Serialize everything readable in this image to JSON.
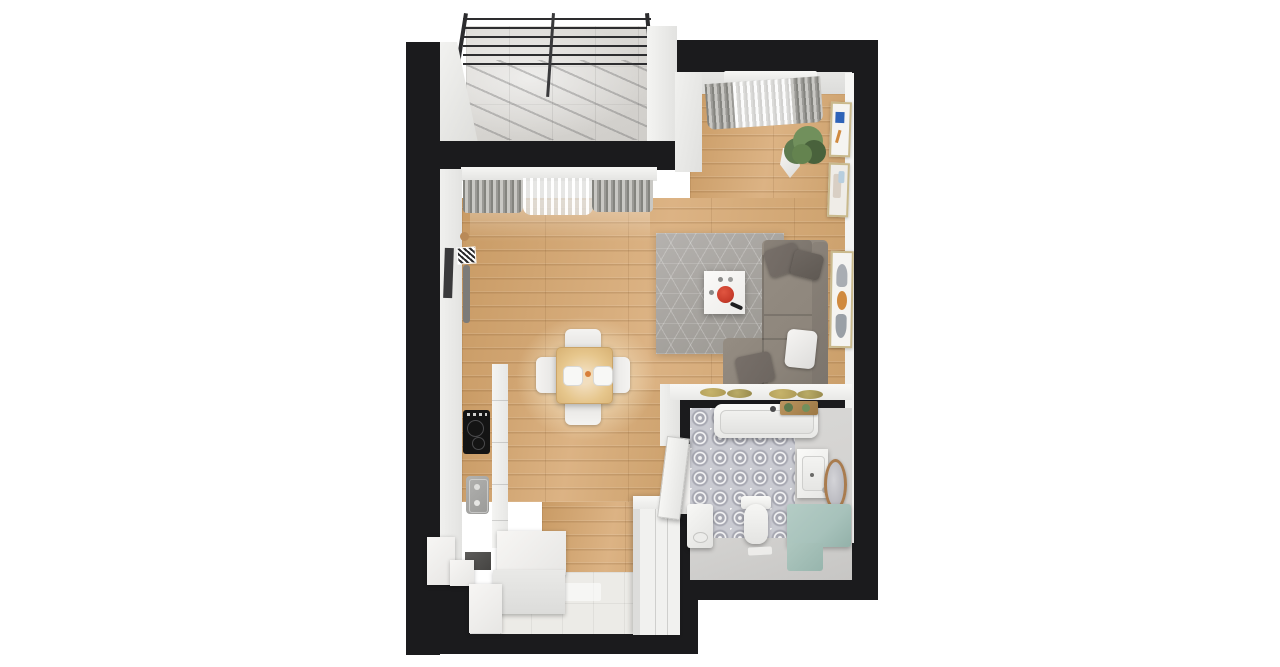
{
  "meta": {
    "title": "Studio apartment 3D floor plan",
    "view": "top-down axonometric render",
    "canvas": {
      "width": 1280,
      "height": 667
    },
    "background": "#ffffff"
  },
  "palette": {
    "wall": "#1b1b1d",
    "interior-wall": "#ebebe9",
    "white-furniture": "#f4f3f1",
    "wood": "#d2a674",
    "rug": "#a8a5a2",
    "sofa": "#8e867c",
    "sofa-dark": "#7b746c",
    "pillow-dark": "#6d6660",
    "counter-dark": "#666563",
    "cooktop": "#121212",
    "accent-red": "#c73b2a",
    "table-wood": "#e6c68c",
    "teal": "#a7c2bb",
    "tile-blue-gray": "#c9cad1",
    "tile-medallion": "#a6a7b1",
    "bath-floor": "#d3d2d0",
    "entry-tile": "#ecebe7",
    "concrete": "#dbd9d5",
    "curtain": "#9b9a96",
    "sheer": "#f3f3f1",
    "plant": "#5d7a4e",
    "plant-light": "#71905c",
    "mirror-wood": "#a97c4f",
    "placemat": "#ad9a56",
    "frame-blue": "#2e63b8",
    "frame-orange": "#d08a3f"
  },
  "rooms": [
    {
      "id": "balcony"
    },
    {
      "id": "living-room"
    },
    {
      "id": "dining-area"
    },
    {
      "id": "kitchen"
    },
    {
      "id": "bathroom"
    },
    {
      "id": "entry-hall"
    }
  ],
  "furniture": {
    "balcony": [
      "glazed-roof",
      "concrete-floor"
    ],
    "living_room": [
      "corner-sofa",
      "throw-pillows",
      "area-rug",
      "coffee-table",
      "decor-bowl",
      "remote",
      "wall-tv",
      "media-sideboard",
      "console-table",
      "placemats",
      "wall-art-frames",
      "potted-plant",
      "window-curtains"
    ],
    "dining_area": [
      "square-table",
      "four-chairs",
      "two-plates",
      "pendant-light-glow"
    ],
    "kitchen": [
      "dark-countertop",
      "induction-cooktop",
      "sink",
      "base-cabinets",
      "island-cabinets"
    ],
    "bathroom": [
      "bathtub",
      "bath-caddy",
      "washbasin-vanity",
      "round-mirror",
      "toilet",
      "washing-machine",
      "teal-bench",
      "patterned-tile-floor",
      "bath-mat",
      "open-door"
    ],
    "entry_hall": [
      "wardrobe",
      "shoe-cabinet",
      "tile-floor"
    ]
  }
}
